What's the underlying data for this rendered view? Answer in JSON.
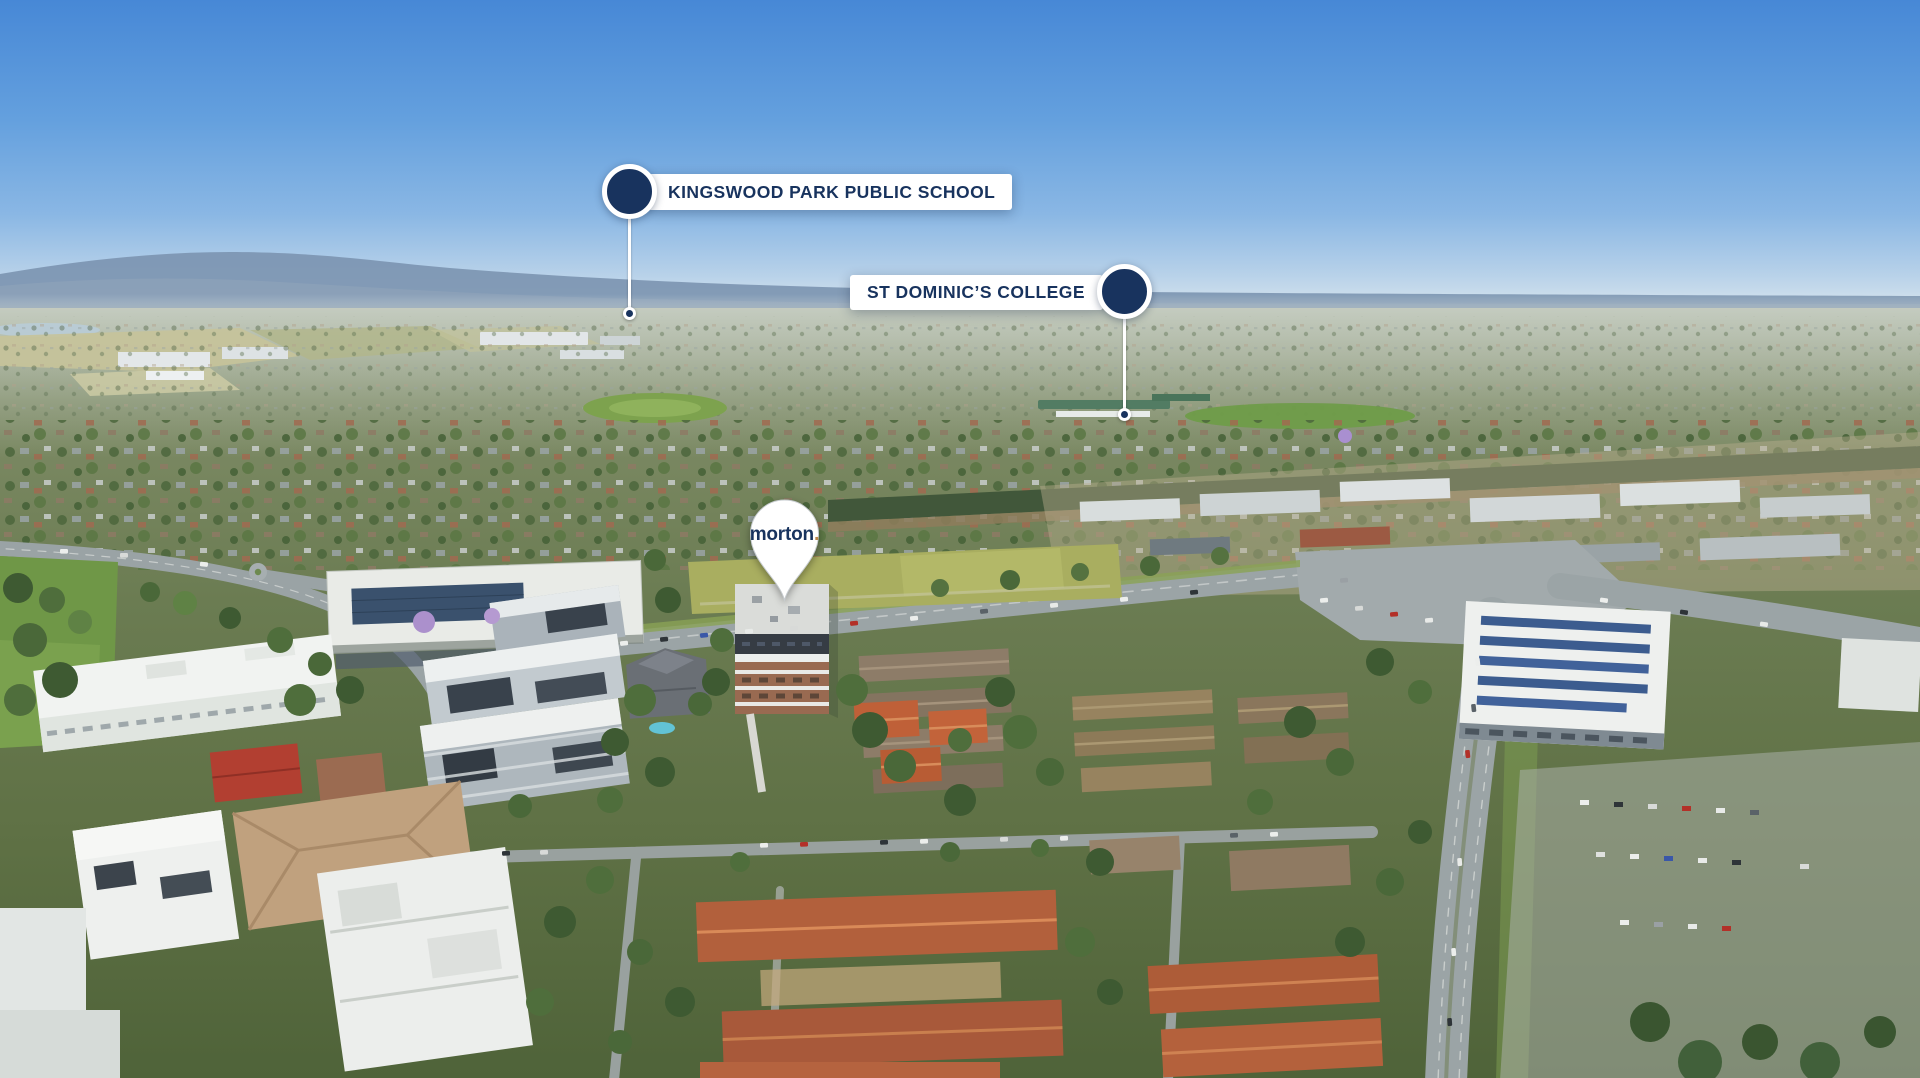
{
  "scene": {
    "type": "aerial-photograph",
    "description": "Drone aerial view over Kingswood suburb: blue sky, Blue Mountains on horizon, suburban houses, highway and apartment buildings, with real-estate location markers",
    "sky_colors": {
      "top": "#4a8bd8",
      "mid": "#8ab7e4",
      "horizon": "#dce7ee"
    },
    "brand_colors": {
      "navy": "#18335e",
      "gold": "#b9854a",
      "marker_white": "#ffffff"
    }
  },
  "markers": [
    {
      "id": "kingswood",
      "label": "KINGSWOOD PARK PUBLIC SCHOOL",
      "label_side": "right"
    },
    {
      "id": "st-dominics",
      "label": "ST DOMINIC’S COLLEGE",
      "label_side": "left"
    }
  ],
  "pin": {
    "brand": "morton",
    "dot": "."
  }
}
